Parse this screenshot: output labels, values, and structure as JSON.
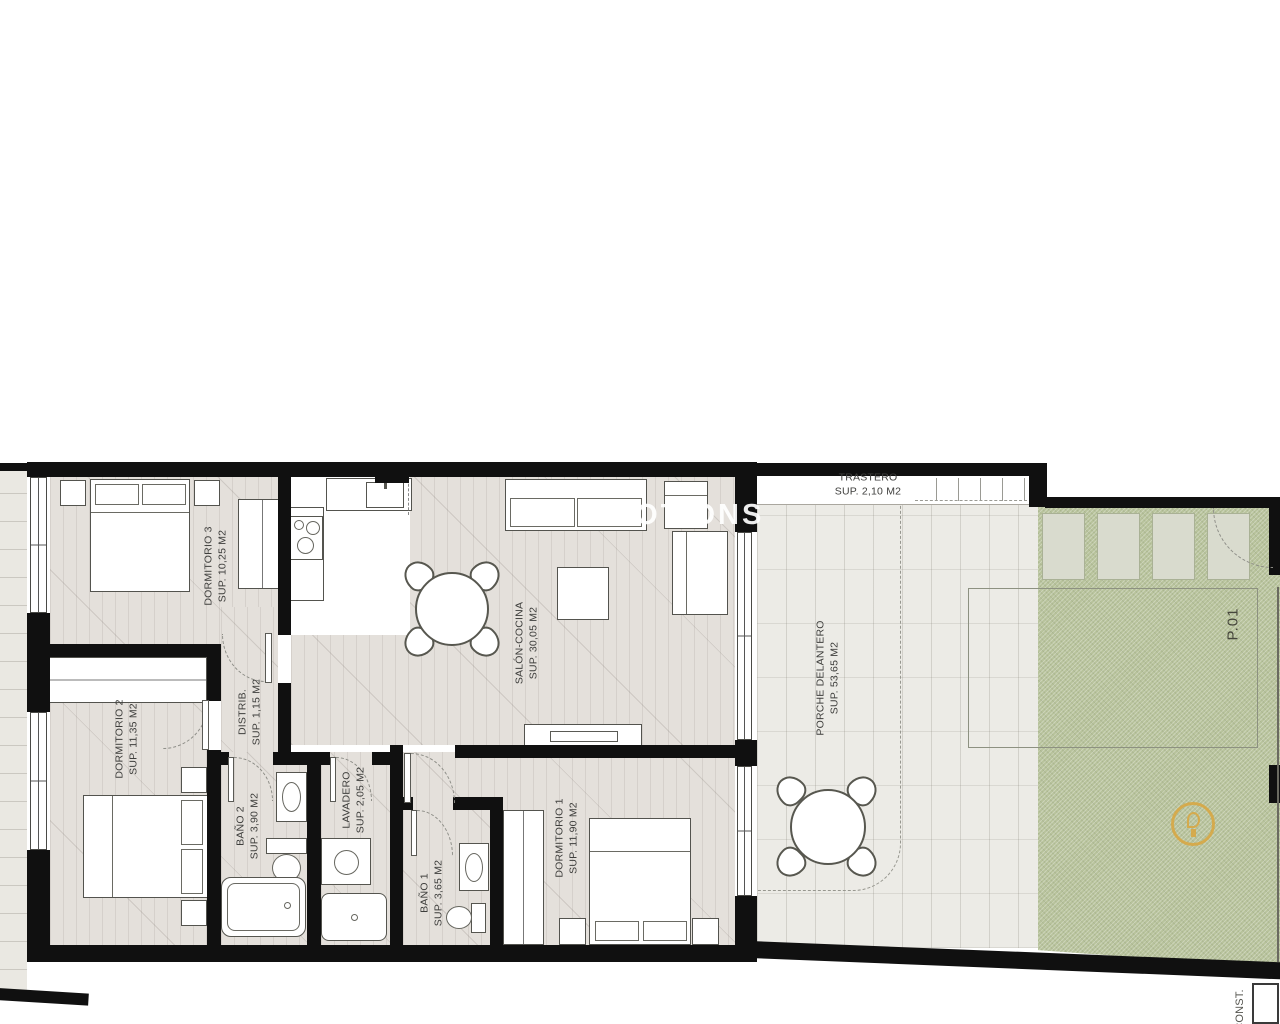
{
  "plan": {
    "watermark": "MOTIONS",
    "plot_label": "P.01",
    "corner_label": "CONST.",
    "rooms": {
      "dormitorio3": {
        "name": "DORMITORIO 3",
        "area": "SUP. 10,25 M2"
      },
      "salon_cocina": {
        "name": "SALÓN-COCINA",
        "area": "SUP. 30,05 M2"
      },
      "distribuidor": {
        "name": "DISTRIB.",
        "area": "SUP. 1,15 M2"
      },
      "dormitorio2": {
        "name": "DORMITORIO 2",
        "area": "SUP. 11,35 M2"
      },
      "bano2": {
        "name": "BAÑO 2",
        "area": "SUP. 3,90 M2"
      },
      "lavadero": {
        "name": "LAVADERO",
        "area": "SUP. 2,05 M2"
      },
      "bano1": {
        "name": "BAÑO 1",
        "area": "SUP. 3,65 M2"
      },
      "dormitorio1": {
        "name": "DORMITORIO 1",
        "area": "SUP. 11,90 M2"
      },
      "porche": {
        "name": "PORCHE DELANTERO",
        "area": "SUP. 53,65 M2"
      },
      "trastero": {
        "name": "TRASTERO",
        "area": "SUP. 2,10 M2"
      }
    },
    "colors": {
      "wall": "#101010",
      "interior_floor": "#e4e0db",
      "porch_floor": "#ecebe6",
      "garden": "#b8c39c",
      "badge_gold": "#d9a63f"
    }
  }
}
